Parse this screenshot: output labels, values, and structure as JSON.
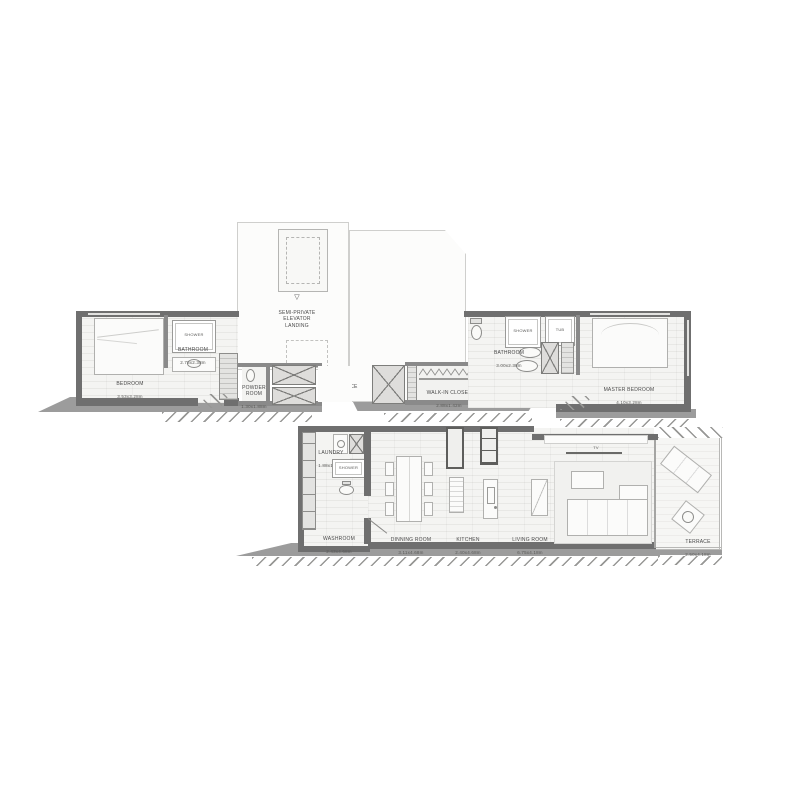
{
  "title": "apartment-floor-plan",
  "colors": {
    "wall": "#6f6f6f",
    "wall_light": "#8f8f8f",
    "floor": "#f4f4f2",
    "white_room": "#fcfcfb",
    "fixture": "#e3e3e1",
    "outline": "#9a9a9a",
    "shadow": "#9c9c9c",
    "label": "#4a4a4a"
  },
  "rooms": {
    "elevator_landing": {
      "symbol": "▽",
      "name": "SEMI-PRIVATE\nELEVATOR\nLANDING"
    },
    "entrance": {
      "name": "ENTRANCE",
      "symbol": "▼"
    },
    "bedroom": {
      "name": "BEDROOM",
      "dims": "3.53x3.28m"
    },
    "bathroom_left": {
      "name": "BATHROOM",
      "dims": "2.78x2.38m"
    },
    "shower_left": {
      "name": "SHOWER"
    },
    "powder_room": {
      "name": "POWDER\nROOM",
      "dims": "1.30x1.88m"
    },
    "walk_in_closet": {
      "name": "WALK-IN  CLOSET",
      "dims": "2.88x1.42m"
    },
    "bathroom_right": {
      "name": "BATHROOM",
      "dims": "3.00x2.38m"
    },
    "shower_right": {
      "name": "SHOWER"
    },
    "tub": {
      "name": "TUB"
    },
    "master_bedroom": {
      "name": "MASTER  BEDROOM",
      "dims": "4.10x3.28m"
    },
    "laundry": {
      "name": "LAUNDRY",
      "dims": "1.88x1.77m"
    },
    "shower_washroom": {
      "name": "SHOWER"
    },
    "washroom": {
      "name": "WASHROOM",
      "dims": "2.43x4.68m"
    },
    "dining_room": {
      "name": "DINNING  ROOM",
      "dims": "3.11x4.68m"
    },
    "kitchen": {
      "name": "KITCHEN",
      "dims": "2.40x4.68m"
    },
    "living_room": {
      "name": "LIVING  ROOM",
      "dims": "6.75x4.18m"
    },
    "terrace": {
      "name": "TERRACE",
      "dims": "2.50x4.18m"
    },
    "tv": {
      "name": "TV"
    }
  }
}
